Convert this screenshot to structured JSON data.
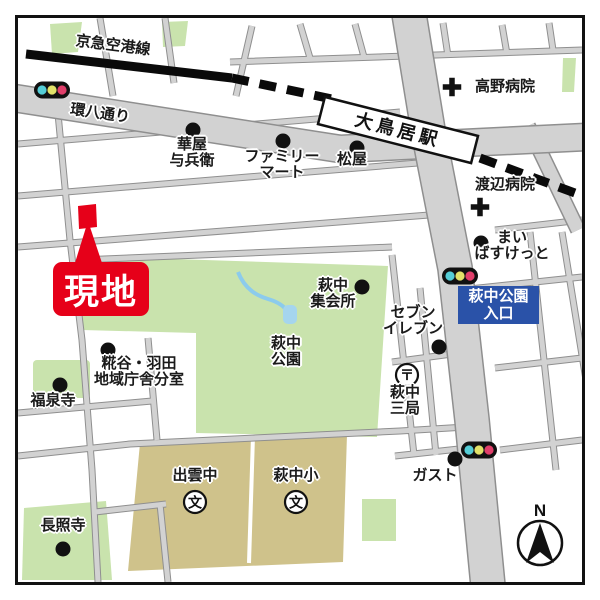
{
  "labels": {
    "railway_line": "京急空港線",
    "kanpachi_street": "環八通り",
    "station": "大鳥居駅",
    "takano_hospital": "高野病院",
    "watanabe_hospital": "渡辺病院",
    "hanaya_yohei": "華屋\n与兵衛",
    "family_mart": "ファミリー\nマート",
    "matsuya": "松屋",
    "maibasket": "まい\nばすけっと",
    "park_entrance_sign": "萩中公園\n入口",
    "site_marker": "現地",
    "haginaka_meeting_hall": "萩中\n集会所",
    "seven_eleven": "セブン\nイレブン",
    "haginaka_park": "萩中\n公園",
    "kojiya_haneda_branch": "糀谷・羽田\n地域庁舎分室",
    "fukusenji_temple": "福泉寺",
    "haginaka_post_office": "萩中\n三局",
    "gusto": "ガスト",
    "izumo_junior_high": "出雲中",
    "haginaka_elementary": "萩中小",
    "choshoji_temple": "長照寺",
    "compass_north": "N",
    "school_symbol": "文",
    "post_symbol": "〒"
  },
  "colors": {
    "road_fill": "#d2d2d2",
    "road_edge": "#8f8f8f",
    "park_green": "#c9e3ad",
    "school_tan": "#cfc28b",
    "water_blue": "#a5d5ee",
    "rail_black": "#0a0a0a",
    "site_red": "#e60019",
    "sign_blue": "#2a52a8",
    "signal_cyan": "#55cdd6",
    "signal_yellow": "#e2e269",
    "signal_red": "#e13f6b"
  }
}
